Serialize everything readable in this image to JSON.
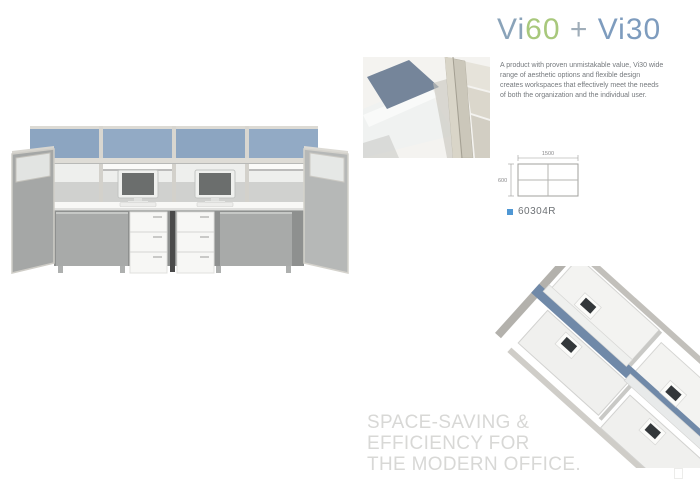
{
  "header": {
    "title": {
      "vi60_a": "Vi",
      "vi60_b": "60",
      "plus": " + ",
      "vi30": "Vi30"
    },
    "title_colors": {
      "vi": "#8aa3b9",
      "sixty_green": "#a8c87c",
      "plus_gray": "#9fadb9",
      "vi30_blue": "#7e9cbe"
    }
  },
  "intro": {
    "description": "A product with proven unmistakable value, Vi30 wide range of aesthetic options and flexible design creates workspaces that effectively meet the needs of both the organization and the individual user."
  },
  "spec": {
    "product_code": "60304R",
    "bullet_color": "#4f97d4",
    "diagram": {
      "width_label": "1500",
      "depth_label": "600"
    }
  },
  "tagline": {
    "line1": "SPACE-SAVING &",
    "line2": "EFFICIENCY FOR",
    "line3": "THE MODERN OFFICE.",
    "color": "#d8d8d6"
  },
  "images": {
    "main_photo": "Front view of two-person Vi30 workstation with blue screen panels, monitors and white drawer pedestals",
    "detail_photo": "Close-up of panel connector post with blue fabric screen",
    "aerial_photo": "Bird's-eye view of four-person workstation cluster with blue spine panel"
  },
  "colors": {
    "panel_blue": "#8ca5c1",
    "panel_gray": "#a8aaa9",
    "frame_light": "#d8d6d0",
    "desk_white": "#f8f8f6"
  }
}
